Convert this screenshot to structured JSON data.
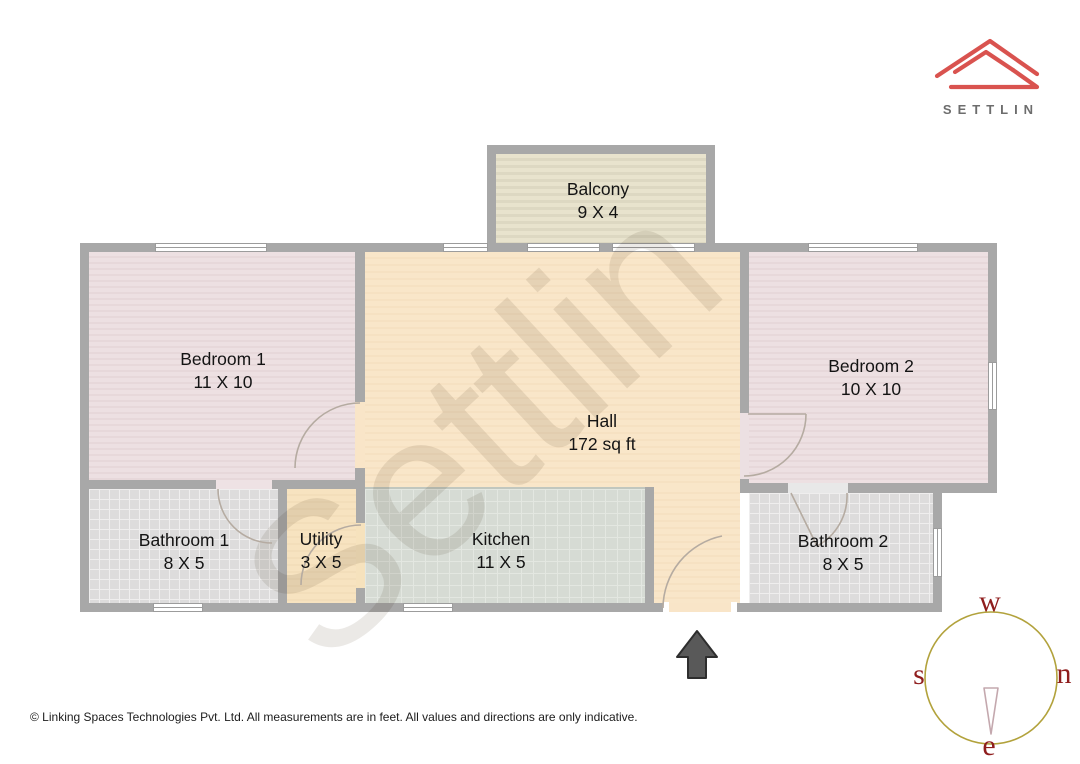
{
  "logo": {
    "brand": "SETTLIN"
  },
  "plan": {
    "watermark": "Settlin",
    "rooms": {
      "balcony": {
        "name": "Balcony",
        "dims": "9 X 4"
      },
      "bedroom1": {
        "name": "Bedroom 1",
        "dims": "11 X 10"
      },
      "hall": {
        "name": "Hall",
        "dims": "172 sq ft"
      },
      "bedroom2": {
        "name": "Bedroom 2",
        "dims": "10 X 10"
      },
      "bathroom1": {
        "name": "Bathroom 1",
        "dims": "8 X 5"
      },
      "utility": {
        "name": "Utility",
        "dims": "3 X 5"
      },
      "kitchen": {
        "name": "Kitchen",
        "dims": "11 X 5"
      },
      "bathroom2": {
        "name": "Bathroom 2",
        "dims": "8 X 5"
      }
    }
  },
  "compass": {
    "top": "w",
    "right": "n",
    "left": "s",
    "bottom": "e"
  },
  "footer": {
    "copyright": "© Linking Spaces Technologies Pvt. Ltd. All measurements are in feet. All values and directions are only indicative."
  },
  "colors": {
    "wall": "#a8a8a8",
    "logo_red": "#d9534f",
    "compass_ring": "#b2a23c",
    "compass_letters": "#8f1d1d",
    "entrance_arrow": "#595959",
    "hall_floor": "#f9e5c8",
    "bedroom_floor": "#ece0e2",
    "bathroom_floor": "#dddcdc",
    "kitchen_floor": "#d6dbd4",
    "balcony_floor": "#e4dfc9"
  }
}
